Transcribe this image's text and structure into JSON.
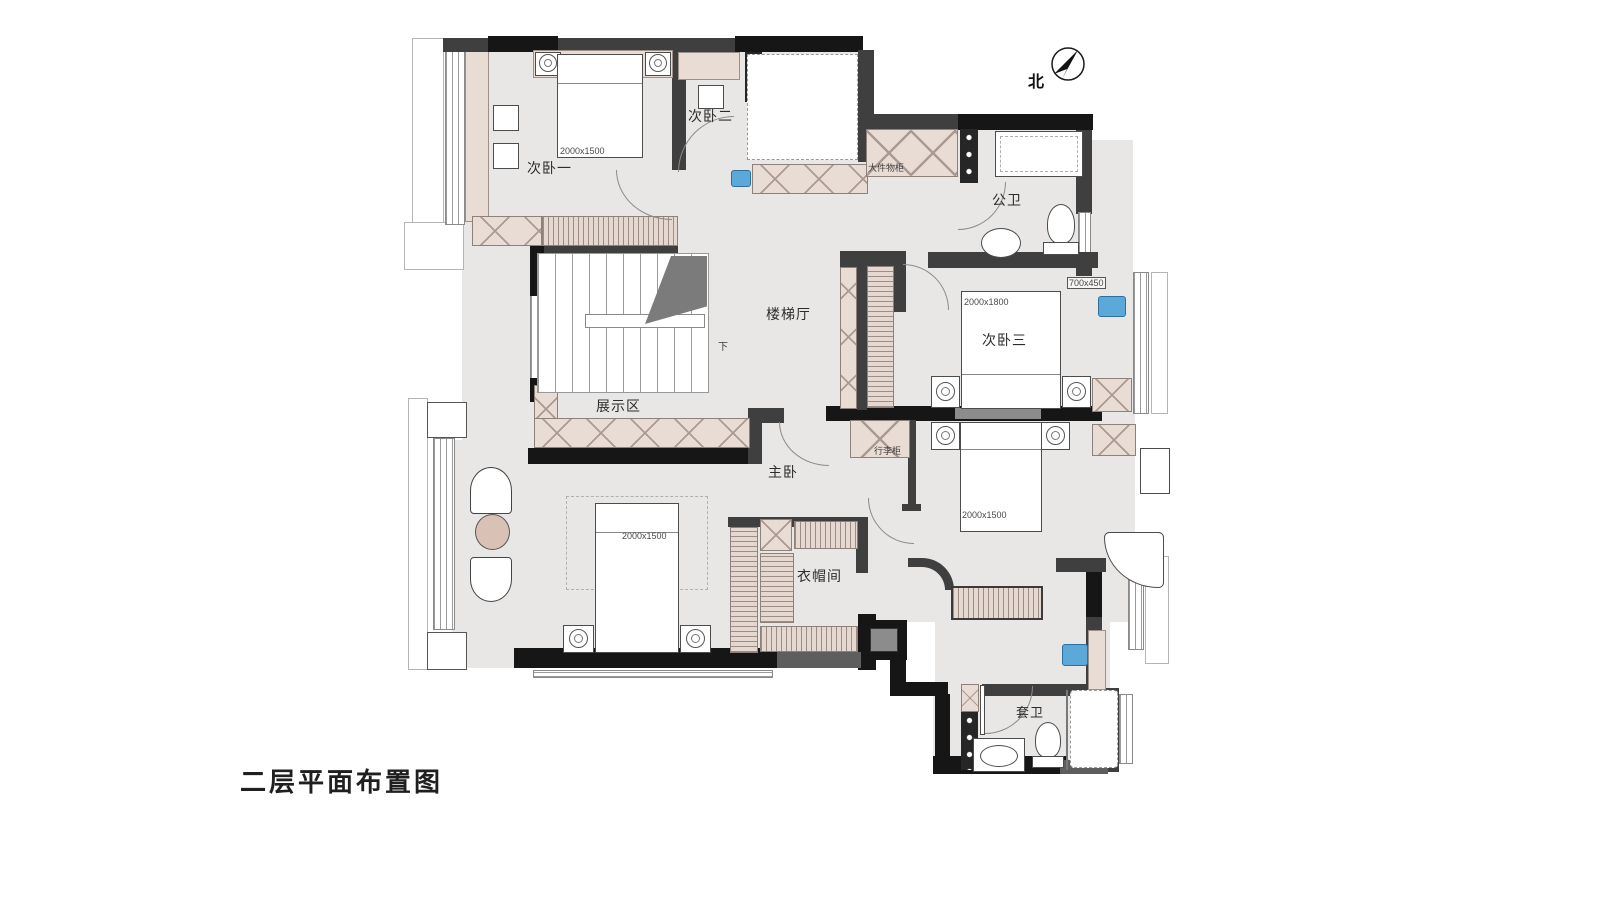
{
  "title": "二层平面布置图",
  "compass": {
    "north": "北"
  },
  "rooms": {
    "bedroom1": "次卧一",
    "bedroom2": "次卧二",
    "bedroom3": "次卧三",
    "public_bath": "公卫",
    "stair_hall": "楼梯厅",
    "display_area": "展示区",
    "master_bedroom": "主卧",
    "cloakroom": "衣帽间",
    "ensuite_bath": "套卫"
  },
  "cabinets": {
    "large_storage": "大件物柜",
    "luggage": "行李柜"
  },
  "stairs": {
    "down": "下"
  },
  "dimensions": {
    "bedroom1_bed": "2000x1500",
    "bedroom3_bed": "2000x1800",
    "bedroom3_cabinet": "700x450",
    "suite_bed": "2000x1500",
    "master_bed": "2000x1500"
  },
  "colors": {
    "wall": "#3f3f3f",
    "wall_black": "#161616",
    "floor": "#e9e7e5",
    "cabinet_fill": "#e9dcd5",
    "accent_blue": "#5ba9d9",
    "side_table": "#d9c1b6"
  }
}
